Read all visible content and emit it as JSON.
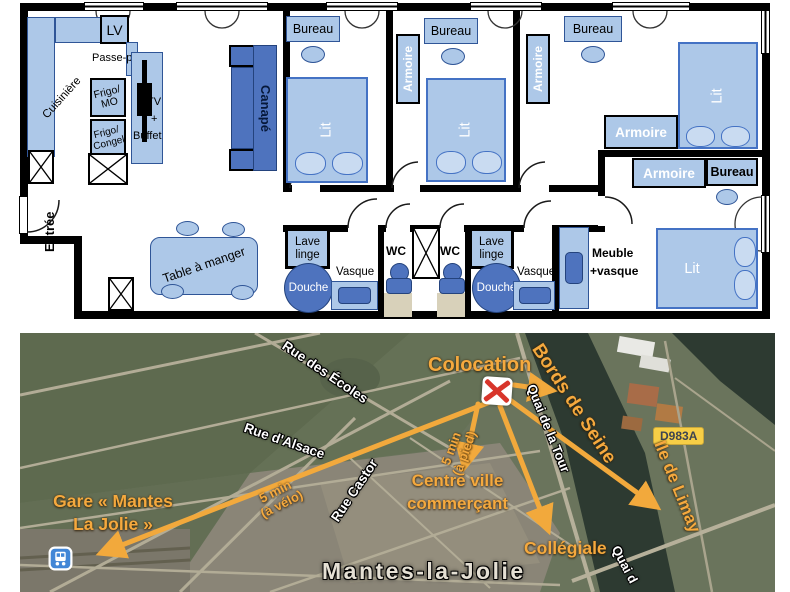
{
  "colors": {
    "plan_light_blue": "#ADC8E8",
    "plan_medium_blue": "#4E73BE",
    "plan_border_blue": "#2F5597",
    "annotation_orange": "#F5A93E",
    "road_badge_yellow": "#F7CE46",
    "river_dark": "#2D3A31",
    "marker_red": "#D8352B"
  },
  "floorplan": {
    "kitchen": {
      "lv": "LV",
      "passe_plat": "Passe-plat",
      "cuisiniere": "Cuisinière",
      "frigo_mo": [
        "Frigo/",
        "MO"
      ],
      "frigo_congel": [
        "Frigo/",
        "Congel"
      ],
      "tv_buffet": [
        "TV",
        "+",
        "Buffet"
      ]
    },
    "living": {
      "canape": "Canapé",
      "table_a_manger": "Table à manger",
      "entree": "Entrée"
    },
    "furniture": {
      "bureau": "Bureau",
      "armoire": "Armoire",
      "lit": "Lit"
    },
    "bathroom": {
      "lave_linge": [
        "Lave",
        "linge"
      ],
      "douche": "Douche",
      "vasque": "Vasque",
      "wc": "WC",
      "meuble_vasque": [
        "Meuble",
        "+vasque"
      ]
    }
  },
  "map": {
    "marker_label": "Colocation",
    "streets": {
      "rue_des_ecoles": "Rue des Écoles",
      "rue_d_alsace": "Rue d'Alsace",
      "rue_castor": "Rue Castor",
      "quai_de_la_tour": "Quai de la Tour",
      "quai_partial": "Quai d",
      "road_badge": "D983A"
    },
    "places": {
      "bords_de_seine": "Bords de Seine",
      "ile_de_limay": "Ile de Limay",
      "gare": [
        "Gare « Mantes",
        "La Jolie »"
      ],
      "centre_ville": [
        "Centre ville",
        "commerçant"
      ],
      "collegiale": "Collégiale",
      "city": "Mantes-la-Jolie"
    },
    "distances": {
      "walk": [
        "5 min",
        "(à pied)"
      ],
      "bike": [
        "5 min",
        "(à vélo)"
      ]
    }
  }
}
